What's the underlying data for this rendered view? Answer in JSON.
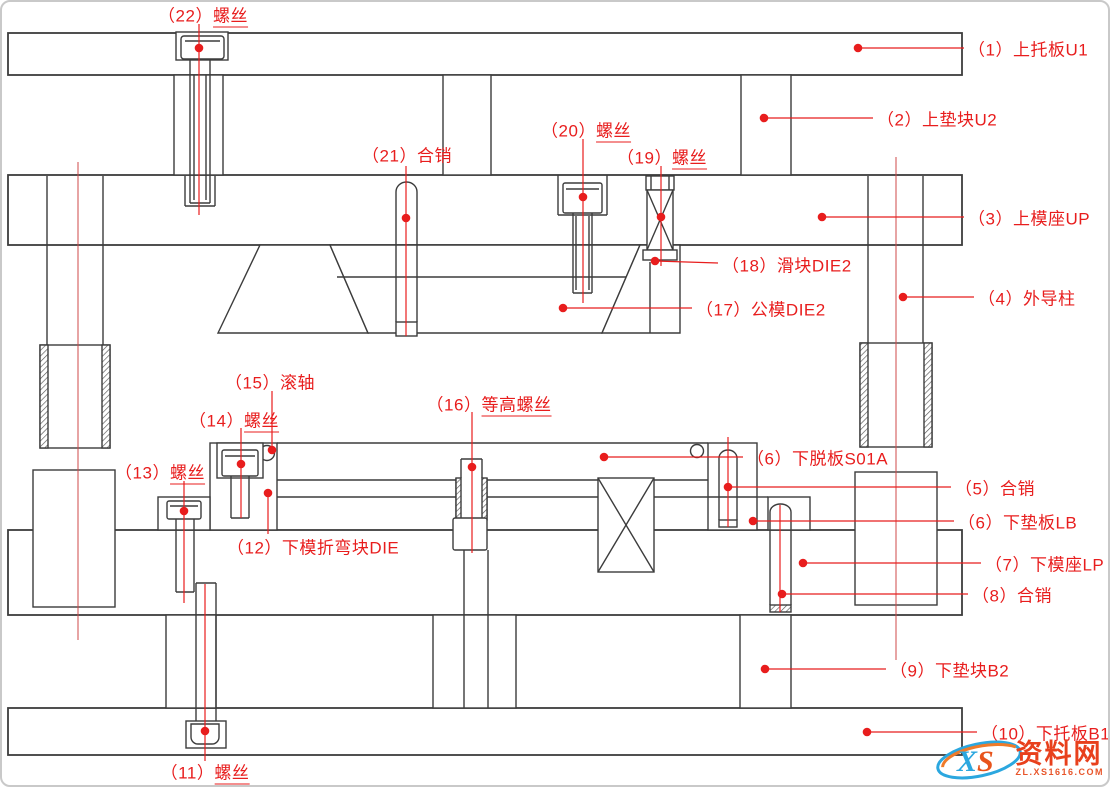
{
  "colors": {
    "line": "#3c3c3c",
    "red": "#e81d1d",
    "centerline_red": "#cf4a4a",
    "logo_blue": "#2ba7df",
    "logo_orange": "#ef7b2a",
    "watermark_red": "#e8401c"
  },
  "watermark": {
    "logo_text": "XS",
    "site_name": "资料网",
    "site_url": "ZL.XS1616.COM"
  },
  "diagram": {
    "centerlines": [
      [
        78,
        162,
        78,
        640
      ],
      [
        896,
        157,
        896,
        660
      ]
    ],
    "callouts": [
      {
        "n": "22",
        "name": "螺丝",
        "underline": true,
        "align": "center",
        "text": [
          203,
          14
        ],
        "dot": [
          199,
          48
        ],
        "segs": [
          [
            199,
            24,
            199,
            215
          ]
        ]
      },
      {
        "n": "1",
        "name": "上托板U1",
        "underline": false,
        "align": "left",
        "text": [
          968,
          48
        ],
        "dot": [
          858,
          48
        ],
        "segs": [
          [
            858,
            48,
            964,
            48
          ]
        ]
      },
      {
        "n": "2",
        "name": "上垫块U2",
        "underline": false,
        "align": "left",
        "text": [
          877,
          118
        ],
        "dot": [
          764,
          118
        ],
        "segs": [
          [
            764,
            118,
            873,
            118
          ]
        ]
      },
      {
        "n": "21",
        "name": "合销",
        "underline": false,
        "align": "center",
        "text": [
          407,
          154
        ],
        "dot": [
          406,
          218
        ],
        "segs": [
          [
            406,
            166,
            406,
            336
          ]
        ]
      },
      {
        "n": "20",
        "name": "螺丝",
        "underline": true,
        "align": "center",
        "text": [
          586,
          129
        ],
        "dot": [
          583,
          197
        ],
        "segs": [
          [
            583,
            139,
            583,
            303
          ]
        ]
      },
      {
        "n": "19",
        "name": "螺丝",
        "underline": true,
        "align": "center",
        "text": [
          662,
          156
        ],
        "dot": [
          661,
          217
        ],
        "segs": [
          [
            661,
            166,
            661,
            266
          ]
        ]
      },
      {
        "n": "3",
        "name": "上模座UP",
        "underline": false,
        "align": "left",
        "text": [
          968,
          217
        ],
        "dot": [
          822,
          217
        ],
        "segs": [
          [
            822,
            217,
            964,
            217
          ]
        ]
      },
      {
        "n": "18",
        "name": "滑块DIE2",
        "underline": false,
        "align": "left",
        "text": [
          722,
          264
        ],
        "dot": [
          655,
          261
        ],
        "segs": [
          [
            655,
            261,
            718,
            263
          ]
        ]
      },
      {
        "n": "17",
        "name": "公模DIE2",
        "underline": false,
        "align": "left",
        "text": [
          696,
          308
        ],
        "dot": [
          563,
          308
        ],
        "segs": [
          [
            563,
            308,
            692,
            308
          ]
        ]
      },
      {
        "n": "4",
        "name": "外导柱",
        "underline": false,
        "align": "left",
        "text": [
          978,
          297
        ],
        "dot": [
          903,
          297
        ],
        "segs": [
          [
            903,
            297,
            974,
            297
          ]
        ]
      },
      {
        "n": "15",
        "name": "滚轴",
        "underline": false,
        "align": "center",
        "text": [
          270,
          381
        ],
        "dot": [
          272,
          450
        ],
        "segs": [
          [
            272,
            391,
            272,
            452
          ]
        ]
      },
      {
        "n": "16",
        "name": "等高螺丝",
        "underline": true,
        "align": "center",
        "text": [
          489,
          403
        ],
        "dot": [
          472,
          467
        ],
        "segs": [
          [
            472,
            412,
            472,
            553
          ]
        ]
      },
      {
        "n": "14",
        "name": "螺丝",
        "underline": true,
        "align": "center",
        "text": [
          234,
          419
        ],
        "dot": [
          241,
          464
        ],
        "segs": [
          [
            241,
            428,
            241,
            518
          ]
        ]
      },
      {
        "n": "13",
        "name": "螺丝",
        "underline": true,
        "align": "center",
        "text": [
          160,
          471
        ],
        "dot": [
          184,
          511
        ],
        "segs": [
          [
            184,
            481,
            184,
            603
          ]
        ]
      },
      {
        "n": "6",
        "name": "下脱板S01A",
        "underline": false,
        "align": "left",
        "text": [
          747,
          457
        ],
        "dot": [
          604,
          457
        ],
        "segs": [
          [
            604,
            457,
            743,
            457
          ]
        ]
      },
      {
        "n": "5",
        "name": "合销",
        "underline": false,
        "align": "left",
        "text": [
          955,
          487
        ],
        "dot": [
          728,
          487
        ],
        "segs": [
          [
            728,
            437,
            728,
            527
          ],
          [
            728,
            487,
            951,
            487
          ]
        ]
      },
      {
        "n": "6",
        "name": "下垫板LB",
        "underline": false,
        "align": "left",
        "text": [
          958,
          521
        ],
        "dot": [
          753,
          521
        ],
        "segs": [
          [
            753,
            521,
            954,
            521
          ]
        ]
      },
      {
        "n": "12",
        "name": "下模折弯块DIE",
        "underline": false,
        "align": "left",
        "text": [
          227,
          546
        ],
        "dot": [
          268,
          493
        ],
        "segs": [
          [
            268,
            493,
            268,
            534
          ]
        ]
      },
      {
        "n": "7",
        "name": "下模座LP",
        "underline": false,
        "align": "left",
        "text": [
          985,
          563
        ],
        "dot": [
          803,
          563
        ],
        "segs": [
          [
            803,
            563,
            981,
            563
          ]
        ]
      },
      {
        "n": "8",
        "name": "合销",
        "underline": false,
        "align": "left",
        "text": [
          972,
          594
        ],
        "dot": [
          782,
          594
        ],
        "segs": [
          [
            780,
            505,
            780,
            612
          ],
          [
            782,
            594,
            968,
            594
          ]
        ]
      },
      {
        "n": "9",
        "name": "下垫块B2",
        "underline": false,
        "align": "left",
        "text": [
          890,
          669
        ],
        "dot": [
          765,
          669
        ],
        "segs": [
          [
            765,
            669,
            886,
            669
          ]
        ]
      },
      {
        "n": "10",
        "name": "下托板B1",
        "underline": false,
        "align": "left",
        "text": [
          981,
          732
        ],
        "dot": [
          867,
          732
        ],
        "segs": [
          [
            867,
            732,
            977,
            732
          ]
        ]
      },
      {
        "n": "11",
        "name": "螺丝",
        "underline": true,
        "align": "center",
        "text": [
          205,
          771
        ],
        "dot": [
          205,
          731
        ],
        "segs": [
          [
            205,
            584,
            205,
            761
          ]
        ]
      }
    ]
  }
}
